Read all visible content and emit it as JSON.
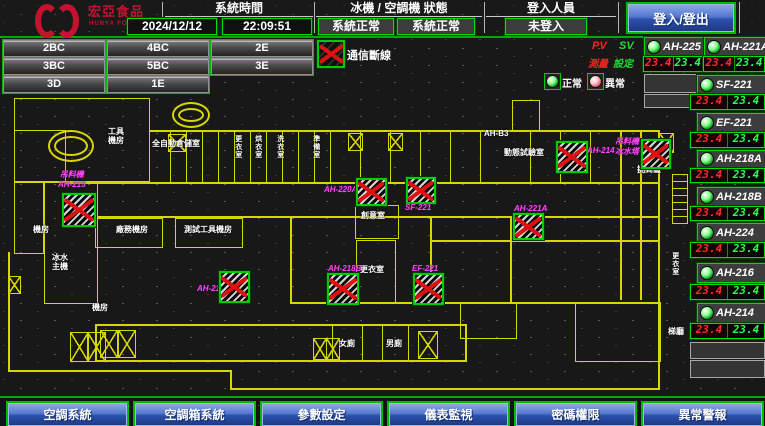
{
  "header": {
    "brand": {
      "name": "宏亞食品",
      "sub": "HUNYA FOODS"
    },
    "system_time": {
      "label": "系統時間",
      "date": "2024/12/12",
      "time": "22:09:51"
    },
    "machine_status": {
      "label": "冰機 / 空調機 狀態",
      "chiller": "系統正常",
      "ahu": "系統正常"
    },
    "login": {
      "label": "登入人員",
      "status": "未登入",
      "button": "登入/登出"
    }
  },
  "floor_buttons": [
    {
      "label": "2BC"
    },
    {
      "label": "4BC"
    },
    {
      "label": "2E"
    },
    {
      "label": "3BC"
    },
    {
      "label": "5BC"
    },
    {
      "label": "3E"
    },
    {
      "label": "3D"
    },
    {
      "label": "1E"
    }
  ],
  "legend": {
    "comm_fail": "通信斷線",
    "pv": "PV",
    "sv": "SV",
    "pv_name": "測量",
    "sv_name": "設定",
    "normal": "正常",
    "abnormal": "異常"
  },
  "units": [
    {
      "name": "AH-225",
      "pv": "23.4",
      "sv": "23.4"
    },
    {
      "name": "AH-221A",
      "pv": "23.4",
      "sv": "23.4"
    },
    {
      "name": "SF-221",
      "pv": "23.4",
      "sv": "23.4"
    },
    {
      "name": "EF-221",
      "pv": "23.4",
      "sv": "23.4"
    },
    {
      "name": "AH-218A",
      "pv": "23.4",
      "sv": "23.4"
    },
    {
      "name": "AH-218B",
      "pv": "23.4",
      "sv": "23.4"
    },
    {
      "name": "AH-224",
      "pv": "23.4",
      "sv": "23.4"
    },
    {
      "name": "AH-216",
      "pv": "23.4",
      "sv": "23.4"
    },
    {
      "name": "AH-214",
      "pv": "23.4",
      "sv": "23.4"
    }
  ],
  "floorplan": {
    "offline_units": [
      {
        "line1": "吊料機",
        "line2": "AH-215"
      },
      {
        "line1": "AH-220A"
      },
      {
        "line1": "SF-221"
      },
      {
        "line1": "AH-214"
      },
      {
        "line1": "吊料機",
        "line2": "冰水塔"
      },
      {
        "line1": "AH-221A"
      },
      {
        "line1": "AH-218"
      },
      {
        "line1": "AH-218B"
      },
      {
        "line1": "EF-221"
      }
    ],
    "rooms": [
      {
        "text": "工具\n機房"
      },
      {
        "text": "全自動倉儲室"
      },
      {
        "text": "更衣室"
      },
      {
        "text": "烘衣室"
      },
      {
        "text": "洗衣室"
      },
      {
        "text": "準備室"
      },
      {
        "text": "機房"
      },
      {
        "text": "廠務機房"
      },
      {
        "text": "測試工具機房"
      },
      {
        "text": "冰水\n主機"
      },
      {
        "text": "創意室"
      },
      {
        "text": "更衣室"
      },
      {
        "text": "動態試驗室"
      },
      {
        "text": "工具室"
      },
      {
        "text": "挑高區"
      },
      {
        "text": "AH-B3"
      },
      {
        "text": "女廁"
      },
      {
        "text": "男廁"
      },
      {
        "text": "梯廳"
      },
      {
        "text": "更衣室"
      },
      {
        "text": "機房"
      }
    ]
  },
  "nav_buttons": [
    {
      "label": "空調系統"
    },
    {
      "label": "空調箱系統"
    },
    {
      "label": "參數設定"
    },
    {
      "label": "儀表監視"
    },
    {
      "label": "密碼權限"
    },
    {
      "label": "異常警報"
    }
  ],
  "colors": {
    "wall": "#d6d600",
    "alarm_x": "#dd1111",
    "magenta_label": "#ff44ff",
    "ok_green": "#00dd00",
    "value_pv": "#ff2a2a",
    "value_sv": "#2aff4a",
    "button_blue": "#2c50ab"
  }
}
